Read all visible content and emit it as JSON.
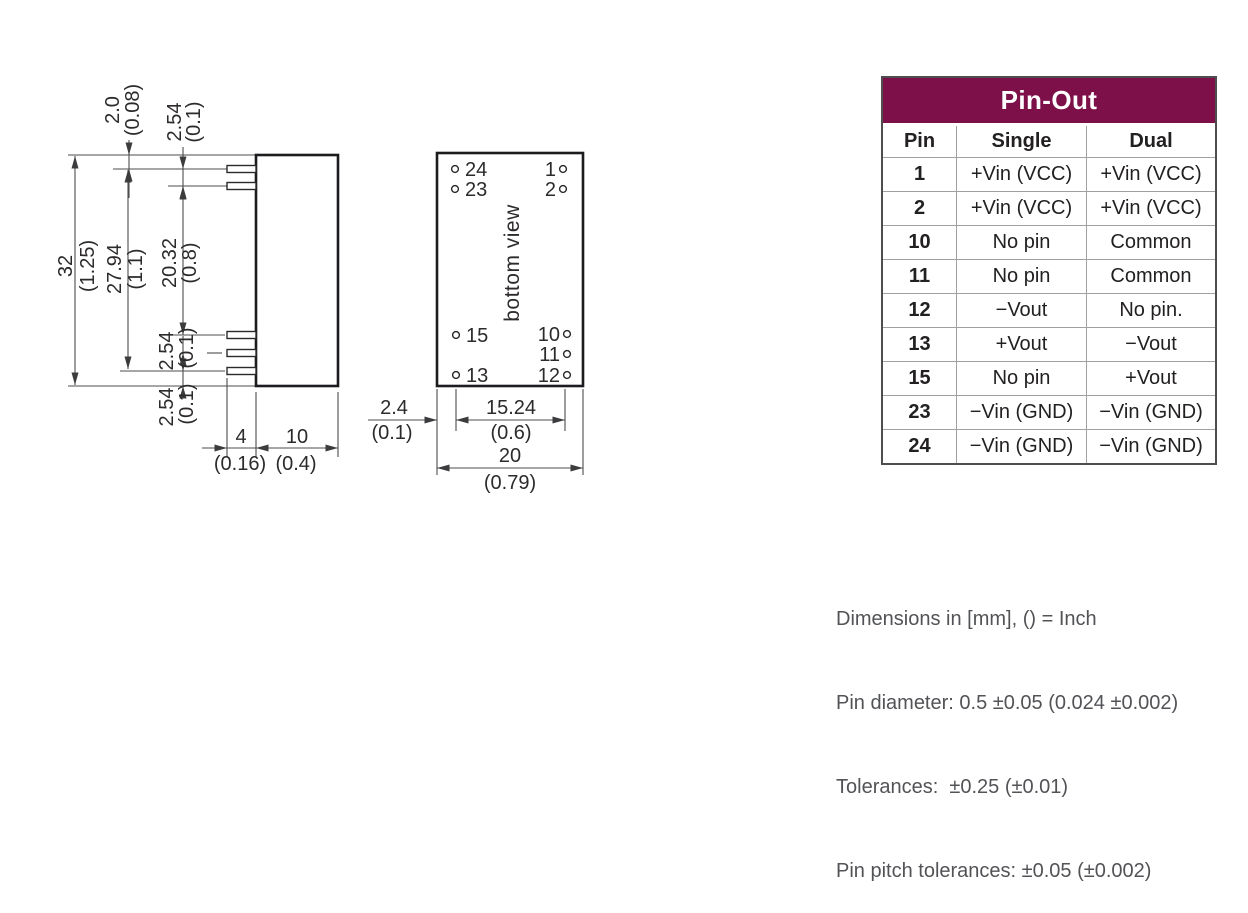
{
  "side_view": {
    "dim_height": "32",
    "dim_height_in": "(1.25)",
    "dim_pin_span": "27.94",
    "dim_pin_span_in": "(1.1)",
    "dim_inner_span": "20.32",
    "dim_inner_span_in": "(0.8)",
    "dim_top_offset": "2.0",
    "dim_top_offset_in": "(0.08)",
    "dim_top_pitch": "2.54",
    "dim_top_pitch_in": "(0.1)",
    "dim_bottom_pitch": "2.54",
    "dim_bottom_pitch_in": "(0.1)",
    "dim_bottom_offset": "2.54",
    "dim_bottom_offset_in": "(0.1)",
    "dim_pin_length": "4",
    "dim_pin_length_in": "(0.16)",
    "dim_depth": "10",
    "dim_depth_in": "(0.4)"
  },
  "bottom_view": {
    "label": "bottom view",
    "pins_left": [
      "24",
      "23",
      "15",
      "13"
    ],
    "pins_right": [
      "1",
      "2",
      "10",
      "11",
      "12"
    ],
    "dim_edge_offset": "2.4",
    "dim_edge_offset_in": "(0.1)",
    "dim_pin_span": "15.24",
    "dim_pin_span_in": "(0.6)",
    "dim_width": "20",
    "dim_width_in": "(0.79)"
  },
  "pinout": {
    "title": "Pin-Out",
    "columns": [
      "Pin",
      "Single",
      "Dual"
    ],
    "rows": [
      {
        "pin": "1",
        "single": "+Vin (VCC)",
        "dual": "+Vin (VCC)"
      },
      {
        "pin": "2",
        "single": "+Vin (VCC)",
        "dual": "+Vin (VCC)"
      },
      {
        "pin": "10",
        "single": "No pin",
        "dual": "Common"
      },
      {
        "pin": "11",
        "single": "No pin",
        "dual": "Common"
      },
      {
        "pin": "12",
        "single": "−Vout",
        "dual": "No pin."
      },
      {
        "pin": "13",
        "single": "+Vout",
        "dual": "−Vout"
      },
      {
        "pin": "15",
        "single": "No pin",
        "dual": "+Vout"
      },
      {
        "pin": "23",
        "single": "−Vin (GND)",
        "dual": "−Vin (GND)"
      },
      {
        "pin": "24",
        "single": "−Vin (GND)",
        "dual": "−Vin (GND)"
      }
    ]
  },
  "notes": {
    "lines": [
      "Dimensions in [mm], () = Inch",
      "Pin diameter: 0.5 ±0.05 (0.024 ±0.002)",
      "Tolerances:  ±0.25 (±0.01)",
      "Pin pitch tolerances: ±0.05 (±0.002)"
    ]
  },
  "colors": {
    "table_header_bg": "#7d1049",
    "table_header_text": "#ffffff",
    "drawing_line": "#4d4d4f",
    "case_outline": "#1c1c1e",
    "text": "#2d2a2b",
    "note_text": "#525356",
    "grid_line": "#a0a0a2"
  }
}
